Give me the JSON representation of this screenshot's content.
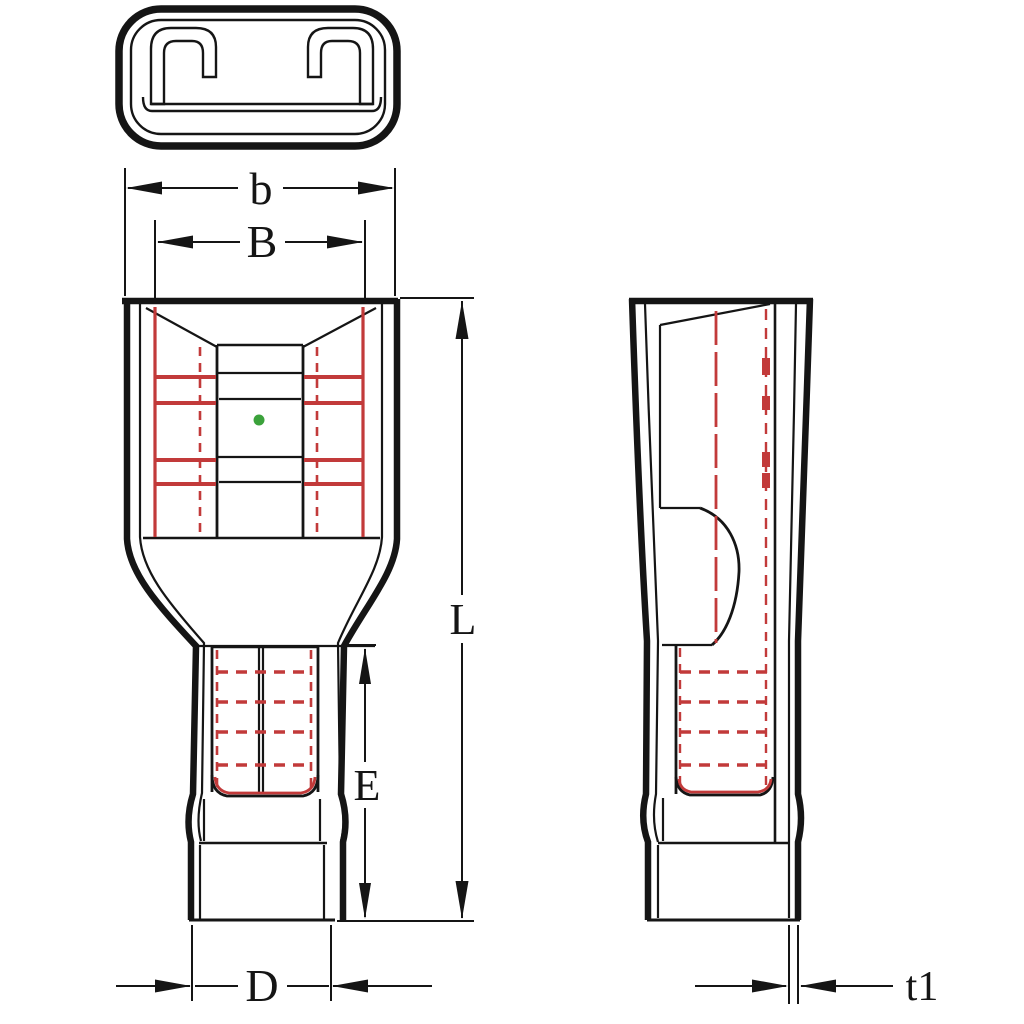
{
  "dimension_labels": {
    "b": "b",
    "B": "B",
    "L": "L",
    "E": "E",
    "D": "D",
    "t1": "t1"
  },
  "colors": {
    "background": "#ffffff",
    "line": "#151515",
    "terminal_red": "#c23a3a",
    "dot_green": "#3ba23b"
  }
}
